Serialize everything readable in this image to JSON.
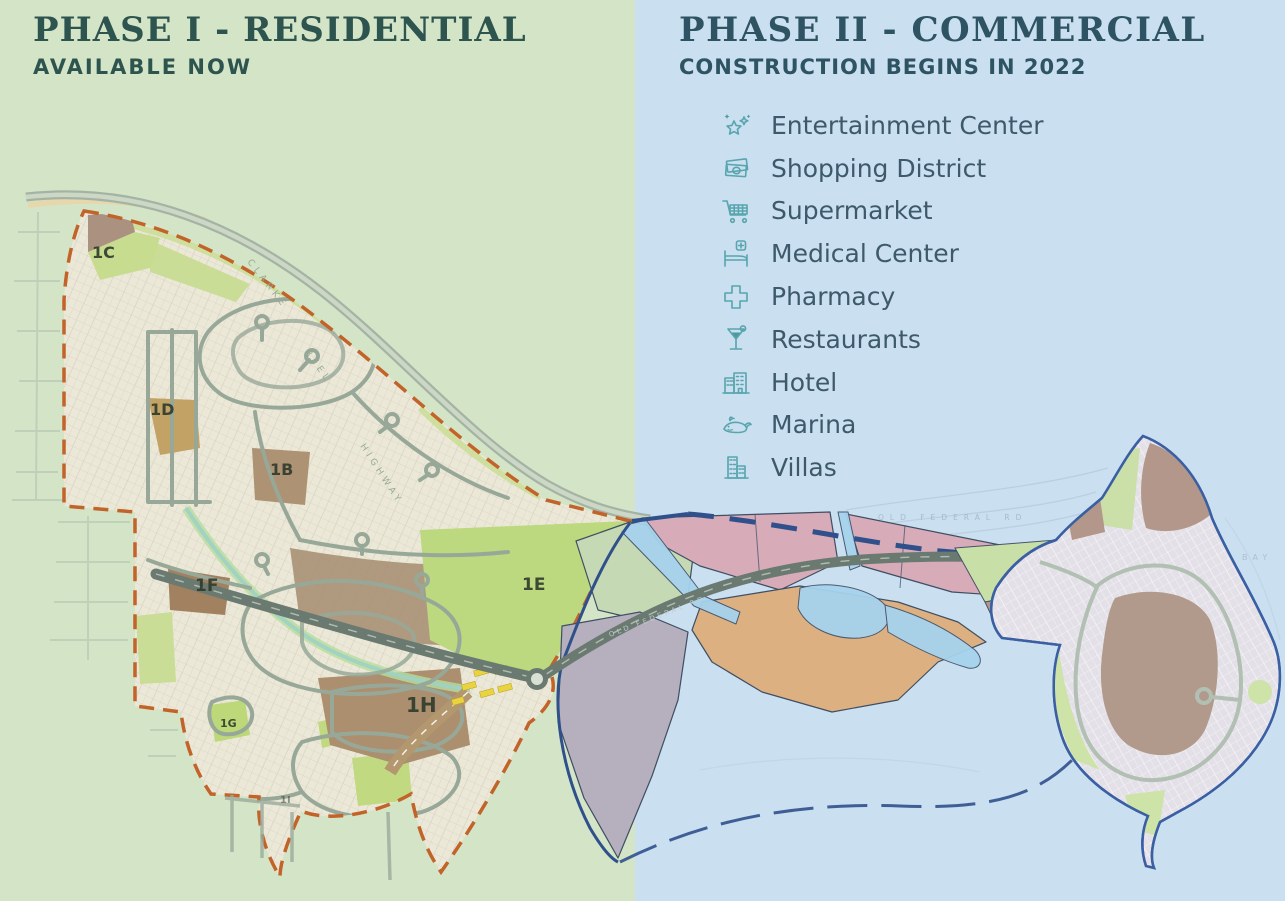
{
  "phase1": {
    "title": "PHASE I - RESIDENTIAL",
    "subtitle": "AVAILABLE NOW"
  },
  "phase2": {
    "title": "PHASE II - COMMERCIAL",
    "subtitle": "CONSTRUCTION BEGINS IN 2022"
  },
  "amenities": [
    {
      "icon": "stars-icon",
      "label": "Entertainment Center"
    },
    {
      "icon": "money-icon",
      "label": "Shopping District"
    },
    {
      "icon": "cart-icon",
      "label": "Supermarket"
    },
    {
      "icon": "medical-bed-icon",
      "label": "Medical Center"
    },
    {
      "icon": "pharmacy-cross-icon",
      "label": "Pharmacy"
    },
    {
      "icon": "cocktail-icon",
      "label": "Restaurants"
    },
    {
      "icon": "hotel-icon",
      "label": "Hotel"
    },
    {
      "icon": "whale-icon",
      "label": "Marina"
    },
    {
      "icon": "villas-icon",
      "label": "Villas"
    }
  ],
  "map": {
    "parcels": {
      "b": "1B",
      "c": "1C",
      "d": "1D",
      "e": "1E",
      "f": "1F",
      "g": "1G",
      "h": "1H",
      "i": "1I"
    },
    "roads": {
      "highway_word1": "CLARKE",
      "highway_word2": "REEL",
      "highway_word3": "HIGHWAY",
      "main_road": "OLD FEDERAL RD",
      "shore_road": "OLD FEDERAL RD"
    },
    "water": {
      "bay": "BAY"
    }
  },
  "colors": {
    "phase1_bg": "#d4e5c7",
    "phase2_bg": "#cadff0",
    "phase1_heading": "#2e544f",
    "phase2_heading": "#2e5362",
    "amenity_text": "#3e5a6a",
    "icon_teal": "#58a5ad",
    "boundary_orange": "#c2632a",
    "boundary_blue": "#30508c",
    "parcel_pink": "#d7abb7",
    "parcel_orange": "#ddb081",
    "parcel_gray": "#b6afbd",
    "parcel_green": "#c5d9b4"
  }
}
